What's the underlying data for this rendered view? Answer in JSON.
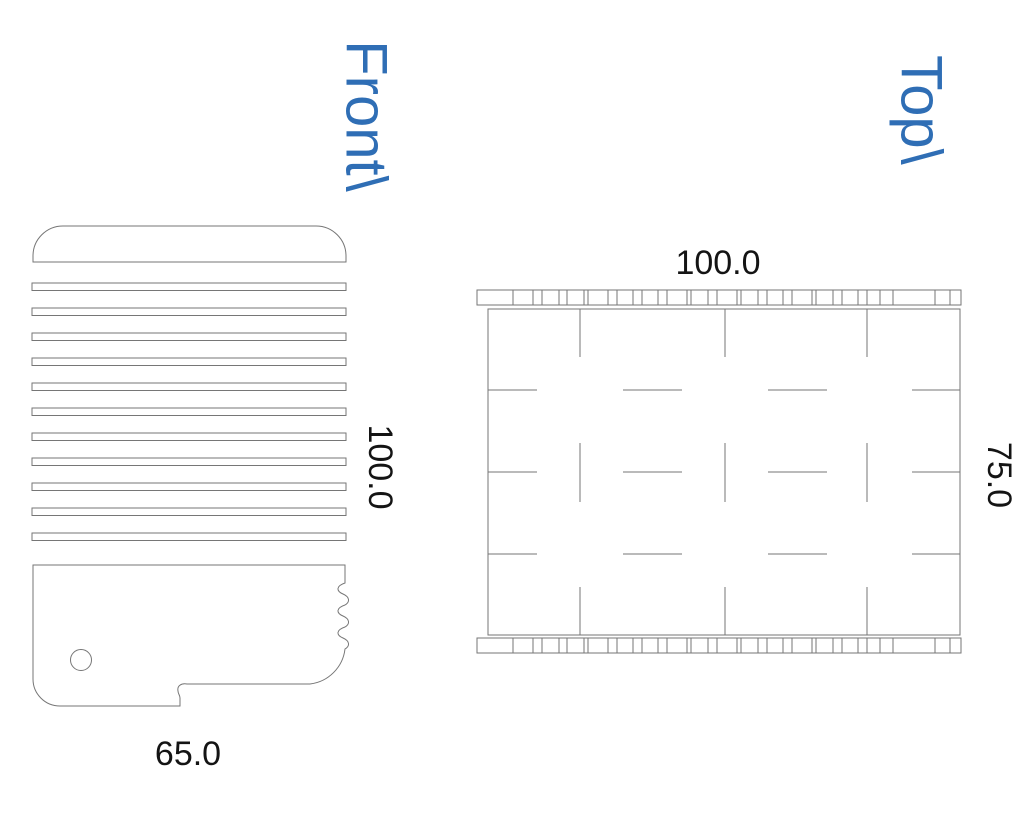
{
  "views": {
    "front": {
      "label": "Front\\",
      "dimensions": {
        "width": "65.0",
        "height": "100.0"
      }
    },
    "top": {
      "label": "Top\\",
      "dimensions": {
        "width": "100.0",
        "depth": "75.0"
      }
    }
  },
  "colors": {
    "label_blue": "#2f6eb5",
    "line_gray": "#767676",
    "dimension_text": "#141414",
    "background": "#ffffff"
  },
  "geometry": {
    "front": {
      "cap": {
        "x": 33,
        "y": 226,
        "width": 313,
        "height": 36,
        "corner_radius": 30
      },
      "slats": {
        "x": 32,
        "width": 314,
        "first_y": 283,
        "pitch": 25.0,
        "height": 7.5,
        "count": 11
      },
      "hole": {
        "cx": 81,
        "cy": 660,
        "r": 10.5
      }
    },
    "top": {
      "strip_x0": 477,
      "strip_x1": 961,
      "strips": [
        {
          "y": 290,
          "height": 15
        },
        {
          "y": 638,
          "height": 15
        }
      ],
      "tick_xs": [
        513,
        533,
        542,
        559,
        567,
        584,
        588,
        608,
        617,
        633,
        642,
        658,
        667,
        687,
        691,
        708,
        717,
        737,
        741,
        758,
        767,
        783,
        792,
        812,
        816,
        833,
        842,
        858,
        867,
        880,
        893,
        935,
        950
      ],
      "rect": {
        "x": 488,
        "y": 309,
        "width": 472,
        "height": 326
      },
      "vertical_xs": [
        580,
        725,
        867
      ],
      "vertical_spans": [
        [
          309,
          357
        ],
        [
          443,
          502
        ],
        [
          587,
          635
        ]
      ],
      "horizontal_ys": [
        390,
        472,
        554
      ],
      "horizontal_spans": [
        [
          488,
          537
        ],
        [
          623,
          682
        ],
        [
          768,
          827
        ],
        [
          912,
          960
        ]
      ]
    }
  }
}
